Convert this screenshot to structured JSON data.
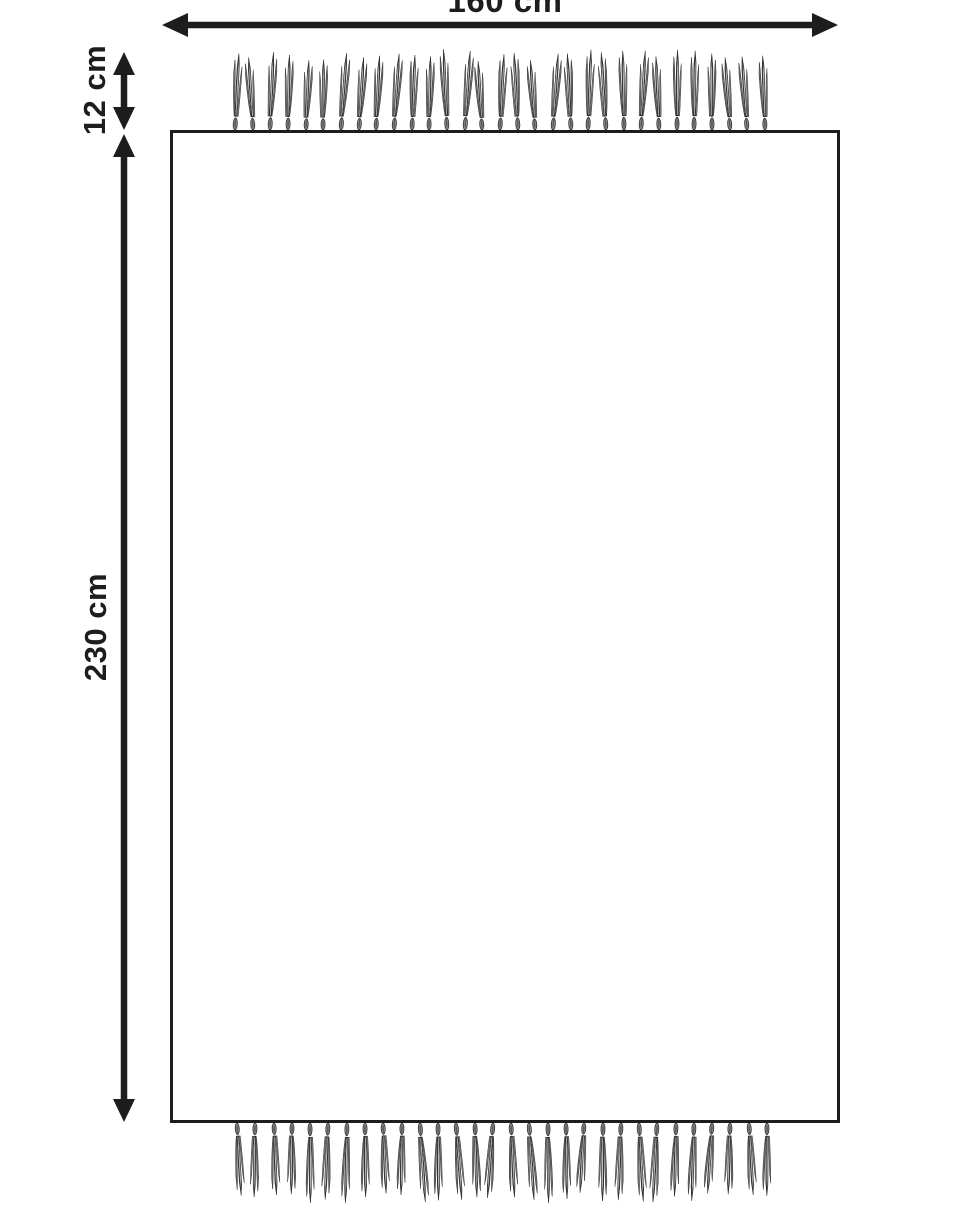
{
  "labels": {
    "width": "160 cm",
    "fringe_length": "12 cm",
    "height": "230 cm"
  },
  "fringe": {
    "top_count": 31,
    "bottom_count": 30
  },
  "colors": {
    "ink": "#1d1d1d",
    "background": "#ffffff",
    "knot_fill": "#999999",
    "knot_stroke": "#2a2a2a",
    "strand_dark": "#3a3a3a",
    "strand_mid": "#6f6f6f",
    "strand_light": "#7e7e7e",
    "strand_highlight": "#c2c2c2"
  }
}
